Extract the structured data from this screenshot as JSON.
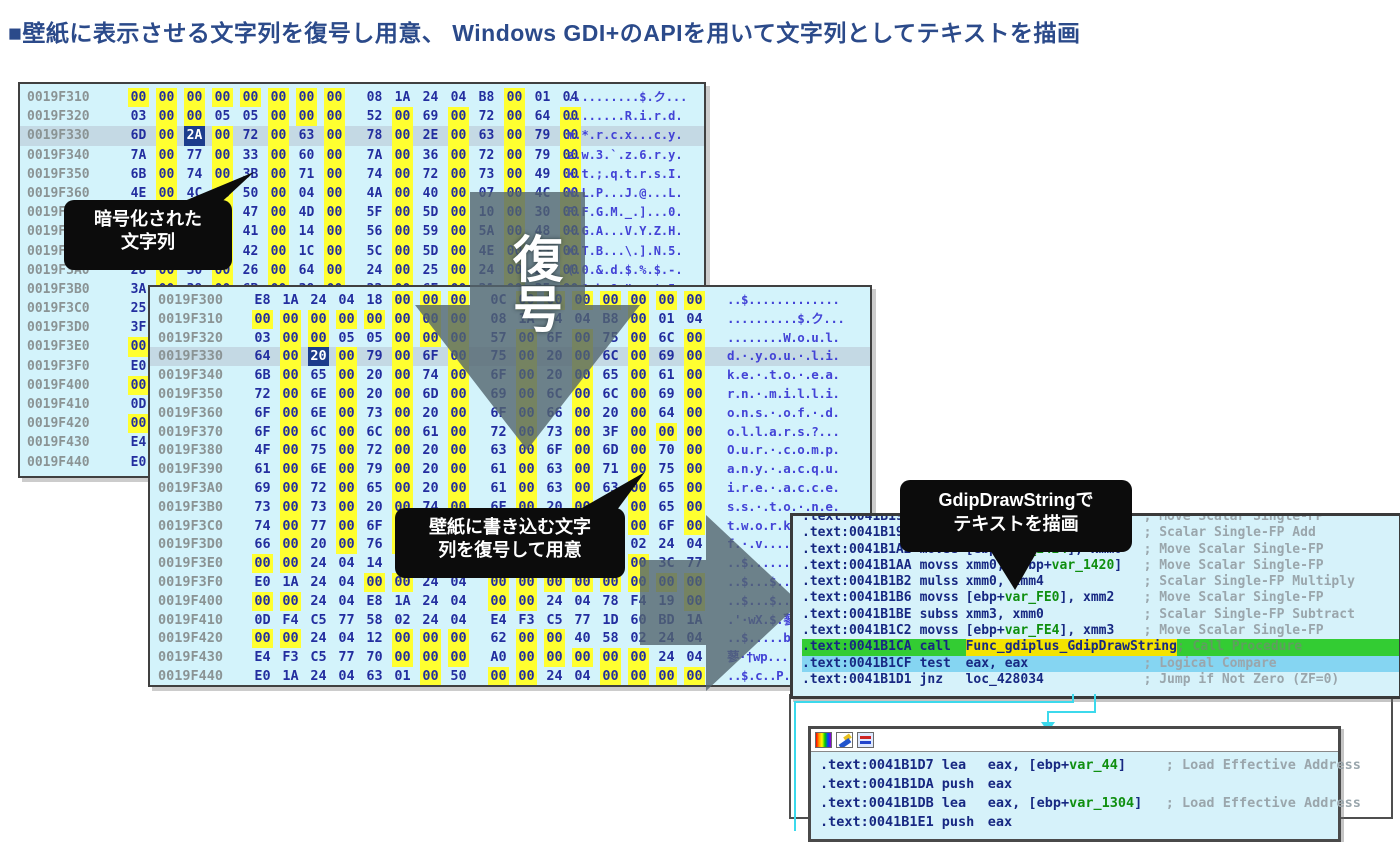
{
  "title": {
    "text": "■壁紙に表示させる文字列を復号し用意、 Windows GDI+のAPIを用いて文字列としてテキストを描画"
  },
  "colors": {
    "title": "#2b4a8a",
    "hex_window_bg": "#d3f3fb",
    "byte_highlight": "#ffff30",
    "selected_byte_bg": "#1c3c8c",
    "row_highlight": "#c4d9e4",
    "hex_text": "#232e9f",
    "ascii_text": "#4343d6",
    "address_text": "#8a9394",
    "call_row_bg": "#33cc33",
    "test_row_bg": "#85d5f2",
    "operand_highlight": "#f4e300",
    "var_token": "#0f8f0f",
    "comment": "#9aa6ac",
    "connector": "#3cd9ec",
    "callout_bg": "#0c0c0c",
    "arrow_overlay": "rgba(82,100,110,0.8)"
  },
  "decode_arrow": {
    "label": "復号"
  },
  "callouts": {
    "encrypted": {
      "line1": "暗号化された",
      "line2": "文字列"
    },
    "decode_note": {
      "line1": "壁紙に書き込む文字",
      "line2": "列を復号して用意"
    },
    "gdip": {
      "line1": "GdipDrawStringで",
      "line2": "テキストを描画"
    }
  },
  "hex_window_1": {
    "selected_row": 2,
    "selected_byte": 2,
    "rows": [
      {
        "addr": "0019F310",
        "bytes": "00 00 00 00 00 00 00 00 08 1A 24 04 B8 00 01 04",
        "ascii": "..........$.ク..."
      },
      {
        "addr": "0019F320",
        "bytes": "03 00 00 05 05 00 00 00 52 00 69 00 72 00 64 00",
        "ascii": "........R.i.r.d."
      },
      {
        "addr": "0019F330",
        "bytes": "6D 00 2A 00 72 00 63 00 78 00 2E 00 63 00 79 00",
        "ascii": "m.*.r.c.x...c.y."
      },
      {
        "addr": "0019F340",
        "bytes": "7A 00 77 00 33 00 60 00 7A 00 36 00 72 00 79 00",
        "ascii": "z.w.3.`.z.6.r.y."
      },
      {
        "addr": "0019F350",
        "bytes": "6B 00 74 00 3B 00 71 00 74 00 72 00 73 00 49 00",
        "ascii": "k.t.;.q.t.r.s.I."
      },
      {
        "addr": "0019F360",
        "bytes": "4E 00 4C 00 50 00 04 00 4A 00 40 00 07 00 4C 00",
        "ascii": "N.L.P...J.@...L."
      },
      {
        "addr": "0019F370",
        "bytes": "46 00 46 00 47 00 4D 00 5F 00 5D 00 10 00 30 00",
        "ascii": "F.F.G.M._.]...0."
      },
      {
        "addr": "0019F380",
        "bytes": "7E 00 47 00 41 00 14 00 56 00 59 00 5A 00 48 00",
        "ascii": "~.G.A...V.Y.Z.H."
      },
      {
        "addr": "0019F390",
        "bytes": "58 00 54 00 42 00 1C 00 5C 00 5D 00 4E 00 35 00",
        "ascii": "X.T.B...\\.].N.5."
      },
      {
        "addr": "0019F3A0",
        "bytes": "28 00 30 00 26 00 64 00 24 00 25 00 24 00 2D 00",
        "ascii": "(.0.&.d.$.%.$.-."
      },
      {
        "addr": "0019F3B0",
        "bytes": "3A 00 39 00 6B 00 38 00 22 00 6E 00 21 00 35 00",
        "ascii": ":.9.k.8.\".n.!.5."
      },
      {
        "addr": "0019F3C0",
        "bytes": "25 00",
        "ascii": ""
      },
      {
        "addr": "0019F3D0",
        "bytes": "3F 00",
        "ascii": ""
      },
      {
        "addr": "0019F3E0",
        "bytes": "00 00",
        "ascii": ""
      },
      {
        "addr": "0019F3F0",
        "bytes": "E0 1A",
        "ascii": ""
      },
      {
        "addr": "0019F400",
        "bytes": "00 00",
        "ascii": ""
      },
      {
        "addr": "0019F410",
        "bytes": "0D F4",
        "ascii": ""
      },
      {
        "addr": "0019F420",
        "bytes": "00 00",
        "ascii": ""
      },
      {
        "addr": "0019F430",
        "bytes": "E4 F3",
        "ascii": ""
      },
      {
        "addr": "0019F440",
        "bytes": "E0 1A",
        "ascii": ""
      }
    ]
  },
  "hex_window_2": {
    "selected_row": 3,
    "selected_byte": 2,
    "rows": [
      {
        "addr": "0019F300",
        "bytes": "E8 1A 24 04 18 00 00 00 0C 00 00 00 00 00 00 00",
        "ascii": "..$............."
      },
      {
        "addr": "0019F310",
        "bytes": "00 00 00 00 00 00 00 00 08 1A 24 04 B8 00 01 04",
        "ascii": "..........$.ク..."
      },
      {
        "addr": "0019F320",
        "bytes": "03 00 00 05 05 00 00 00 57 00 6F 00 75 00 6C 00",
        "ascii": "........W.o.u.l."
      },
      {
        "addr": "0019F330",
        "bytes": "64 00 20 00 79 00 6F 00 75 00 20 00 6C 00 69 00",
        "ascii": "d.·.y.o.u.·.l.i."
      },
      {
        "addr": "0019F340",
        "bytes": "6B 00 65 00 20 00 74 00 6F 00 20 00 65 00 61 00",
        "ascii": "k.e.·.t.o.·.e.a."
      },
      {
        "addr": "0019F350",
        "bytes": "72 00 6E 00 20 00 6D 00 69 00 6C 00 6C 00 69 00",
        "ascii": "r.n.·.m.i.l.l.i."
      },
      {
        "addr": "0019F360",
        "bytes": "6F 00 6E 00 73 00 20 00 6F 00 66 00 20 00 64 00",
        "ascii": "o.n.s.·.o.f.·.d."
      },
      {
        "addr": "0019F370",
        "bytes": "6F 00 6C 00 6C 00 61 00 72 00 73 00 3F 00 00 00",
        "ascii": "o.l.l.a.r.s.?..."
      },
      {
        "addr": "0019F380",
        "bytes": "4F 00 75 00 72 00 20 00 63 00 6F 00 6D 00 70 00",
        "ascii": "O.u.r.·.c.o.m.p."
      },
      {
        "addr": "0019F390",
        "bytes": "61 00 6E 00 79 00 20 00 61 00 63 00 71 00 75 00",
        "ascii": "a.n.y.·.a.c.q.u."
      },
      {
        "addr": "0019F3A0",
        "bytes": "69 00 72 00 65 00 20 00 61 00 63 00 63 00 65 00",
        "ascii": "i.r.e.·.a.c.c.e."
      },
      {
        "addr": "0019F3B0",
        "bytes": "73 00 73 00 20 00 74 00 6F 00 20 00 6E 00 65 00",
        "ascii": "s.s.·.t.o.·.n.e."
      },
      {
        "addr": "0019F3C0",
        "bytes": "74 00 77 00 6F 00 72 00 6B 00 73 00 20 00 6F 00",
        "ascii": "t.w.o.r.k.s."
      },
      {
        "addr": "0019F3D0",
        "bytes": "66 00 20 00 76 00 00 00 00 00 00 00 58 02 24 04",
        "ascii": "f.·.v......"
      },
      {
        "addr": "0019F3E0",
        "bytes": "00 00 24 04 14 F4 19 00 E0 1A 24 04 00 00 3C 77",
        "ascii": "..$........"
      },
      {
        "addr": "0019F3F0",
        "bytes": "E0 1A 24 04 00 00 24 04 00 00 00 00 00 00 00 00",
        "ascii": "..$...$...."
      },
      {
        "addr": "0019F400",
        "bytes": "00 00 24 04 E8 1A 24 04 00 00 24 04 78 F4 19 00",
        "ascii": "..$...$...$."
      },
      {
        "addr": "0019F410",
        "bytes": "0D F4 C5 77 58 02 24 04 E4 F3 C5 77 1D 60 BD 1A",
        "ascii": ".'·wX.$.蓼·"
      },
      {
        "addr": "0019F420",
        "bytes": "00 00 24 04 12 00 00 00 62 00 00 40 58 02 24 04",
        "ascii": "..$.....b..@"
      },
      {
        "addr": "0019F430",
        "bytes": "E4 F3 C5 77 70 00 00 00 A0 00 00 00 00 00 24 04",
        "ascii": "蓼·†wp......"
      },
      {
        "addr": "0019F440",
        "bytes": "E0 1A 24 04 63 01 00 50 00 00 24 04 00 00 00 00",
        "ascii": "..$.c..P..$."
      }
    ]
  },
  "asm_window": {
    "lines": [
      {
        "addr": ".text:0041B192",
        "mnem": "movss",
        "ops": "[ebp+var_FDC], xmm1",
        "comment": "; Move Scalar Single-FP",
        "row": "normal"
      },
      {
        "addr": ".text:0041B19A",
        "mnem": "addss",
        "ops": "xmm2, xmm0",
        "comment": "; Scalar Single-FP Add",
        "row": "normal"
      },
      {
        "addr": ".text:0041B1A2",
        "mnem": "movss",
        "ops": "[ebp+var_1424], xmm0",
        "comment": "; Move Scalar Single-FP",
        "row": "normal"
      },
      {
        "addr": ".text:0041B1AA",
        "mnem": "movss",
        "ops": "xmm0, [ebp+var_1420]",
        "comment": "; Move Scalar Single-FP",
        "row": "normal"
      },
      {
        "addr": ".text:0041B1B2",
        "mnem": "mulss",
        "ops": "xmm0, xmm4",
        "comment": "; Scalar Single-FP Multiply",
        "row": "normal"
      },
      {
        "addr": ".text:0041B1B6",
        "mnem": "movss",
        "ops": "[ebp+var_FE0], xmm2",
        "comment": "; Move Scalar Single-FP",
        "row": "normal"
      },
      {
        "addr": ".text:0041B1BE",
        "mnem": "subss",
        "ops": "xmm3, xmm0",
        "comment": "; Scalar Single-FP Subtract",
        "row": "normal"
      },
      {
        "addr": ".text:0041B1C2",
        "mnem": "movss",
        "ops": "[ebp+var_FE4], xmm3",
        "comment": "; Move Scalar Single-FP",
        "row": "normal"
      },
      {
        "addr": ".text:0041B1CA",
        "mnem": "call",
        "ops": "Func_gdiplus_GdipDrawString",
        "comment": "; Call Procedure",
        "row": "green",
        "ops_hl": true
      },
      {
        "addr": ".text:0041B1CF",
        "mnem": "test",
        "ops": "eax, eax",
        "comment": "; Logical Compare",
        "row": "blue"
      },
      {
        "addr": ".text:0041B1D1",
        "mnem": "jnz",
        "ops": "loc_428034",
        "comment": "; Jump if Not Zero (ZF=0)",
        "row": "normal"
      }
    ]
  },
  "asm_window_2": {
    "toolbar_icons": [
      "palette-icon",
      "pencil-icon",
      "segments-icon"
    ],
    "lines": [
      {
        "addr": ".text:0041B1D7",
        "mnem": "lea",
        "ops": "eax, [ebp+var_44]",
        "comment": "; Load Effective Address",
        "row": "normal"
      },
      {
        "addr": ".text:0041B1DA",
        "mnem": "push",
        "ops": "eax",
        "comment": "",
        "row": "normal"
      },
      {
        "addr": ".text:0041B1DB",
        "mnem": "lea",
        "ops": "eax, [ebp+var_1304]",
        "comment": "; Load Effective Address",
        "row": "normal"
      },
      {
        "addr": ".text:0041B1E1",
        "mnem": "push",
        "ops": "eax",
        "comment": "",
        "row": "normal"
      }
    ]
  }
}
